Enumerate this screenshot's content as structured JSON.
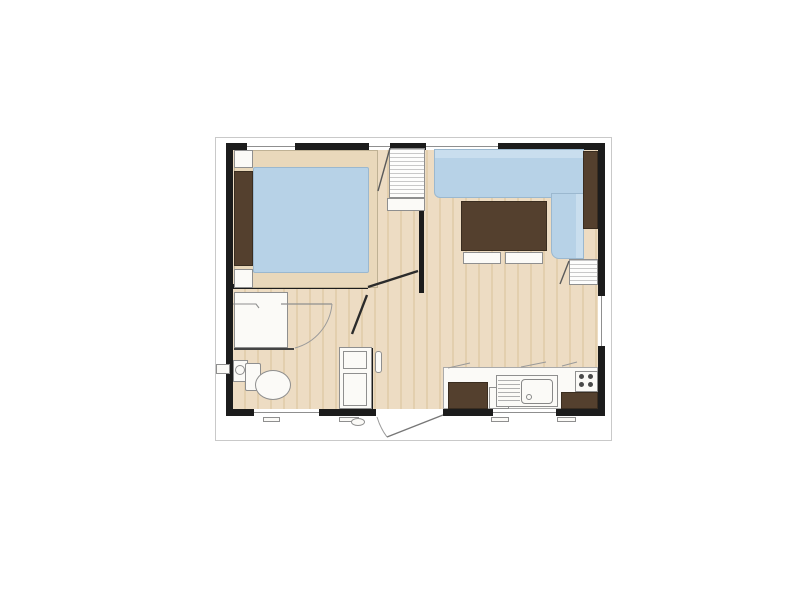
{
  "colors": {
    "wall": "#1c1c1c",
    "frame": "#c9c9c9",
    "floor": "#eddcc3",
    "floor_stripe": "#e3cfae",
    "upholstery": "#b7d2e7",
    "upholstery_light": "#c9deee",
    "wood_dark": "#54402e",
    "wood_dark_border": "#3a2d20",
    "fixture": "#fbfaf7",
    "outline": "#8f8f8f",
    "platform": "#e9d8bb",
    "platform_border": "#bfb194",
    "hatch": "#c8c8c8"
  },
  "plan": {
    "rooms": {
      "bedroom": [
        "double-bed",
        "mattress",
        "headboard",
        "nightstand-top",
        "nightstand-bottom",
        "wardrobe-shelves"
      ],
      "living_room": [
        "corner-sofa",
        "coffee-table",
        "bench-left",
        "bench-right",
        "sideboard",
        "shelf-unit"
      ],
      "bathroom": [
        "shower",
        "shower-door",
        "toilet",
        "washbasin",
        "vanity-unit",
        "wall-tap"
      ],
      "kitchen": [
        "counter",
        "base-cabinet-left",
        "appliance-front",
        "sink-with-drainboard",
        "stove-4-burners",
        "base-cabinet-right"
      ]
    },
    "openings": {
      "windows": [
        "top-bedroom",
        "top-wardrobe",
        "top-living",
        "right-living",
        "bottom-bathroom",
        "bottom-kitchen"
      ],
      "doors": [
        "entry-door-swing-out",
        "bedroom-door",
        "bathroom-door",
        "shower-door",
        "wardrobe-door",
        "shelf-unit-door"
      ]
    },
    "exterior_details": [
      "support-feet-x4",
      "entry-step"
    ]
  }
}
